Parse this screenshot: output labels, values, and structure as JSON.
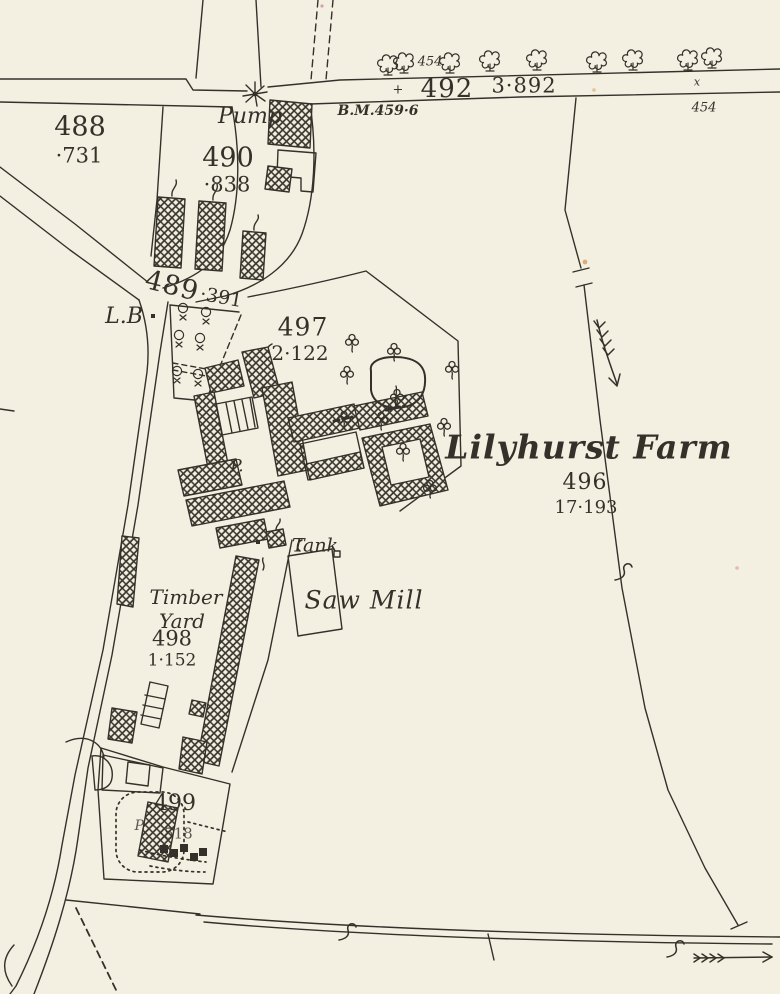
{
  "map": {
    "region_name": "Lilyhurst Farm",
    "colors": {
      "paper": "#f3f0e2",
      "ink": "#34312a"
    },
    "labels": {
      "farm_name": "Lilyhurst Farm",
      "pump": "Pump",
      "pump_abbrev": "P.",
      "pump_abbrev_2": "P.",
      "letter_box": "L.B",
      "tank": "Tank",
      "saw_mill": "Saw Mill",
      "timber_yard_line1": "Timber",
      "timber_yard_line2": "Yard",
      "bench_mark": "B.M.459·6",
      "bm_cross": "+",
      "gate_mark": "x",
      "spot_height_road_west": "454",
      "spot_height_road_east": "454",
      "parcel_488_number": "488",
      "parcel_488_area": "·731",
      "parcel_490_number": "490",
      "parcel_490_area": "·838",
      "parcel_489_number": "489",
      "parcel_489_area": "·391",
      "parcel_492_number": "492",
      "parcel_492_area": "3·892",
      "parcel_497_number": "497",
      "parcel_497_area": "2·122",
      "parcel_496_number": "496",
      "parcel_496_area": "17·193",
      "parcel_498_number": "498",
      "parcel_498_area": "1·152",
      "parcel_499_number": "499",
      "parcel_499_area": "·518"
    }
  }
}
